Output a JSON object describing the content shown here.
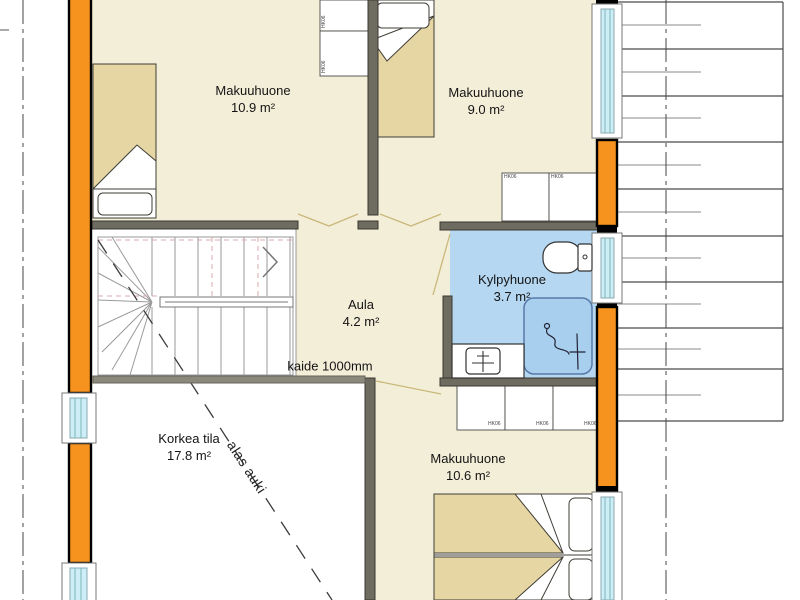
{
  "rooms": {
    "bedroom1": {
      "name": "Makuuhuone",
      "area": "10.9 m²"
    },
    "bedroom2": {
      "name": "Makuuhuone",
      "area": "9.0 m²"
    },
    "bathroom": {
      "name": "Kylpyhuone",
      "area": "3.7 m²"
    },
    "hall": {
      "name": "Aula",
      "area": "4.2 m²"
    },
    "void": {
      "name": "Korkea tila",
      "area": "17.8 m²"
    },
    "bedroom3": {
      "name": "Makuuhuone",
      "area": "10.6 m²"
    }
  },
  "annotations": {
    "railing": "kaide 1000mm",
    "open_below": "alas auki",
    "closet": "HK06"
  },
  "colors": {
    "floor": "#f3eed8",
    "bathroom_floor": "#b5d7f1",
    "shower_floor": "#a9cfee",
    "wall": "#6e6b60",
    "railing": "#8b887c",
    "wood_wall": "#f6921e",
    "window_glass": "#cdeef6",
    "bed": "#e6d6a3"
  }
}
